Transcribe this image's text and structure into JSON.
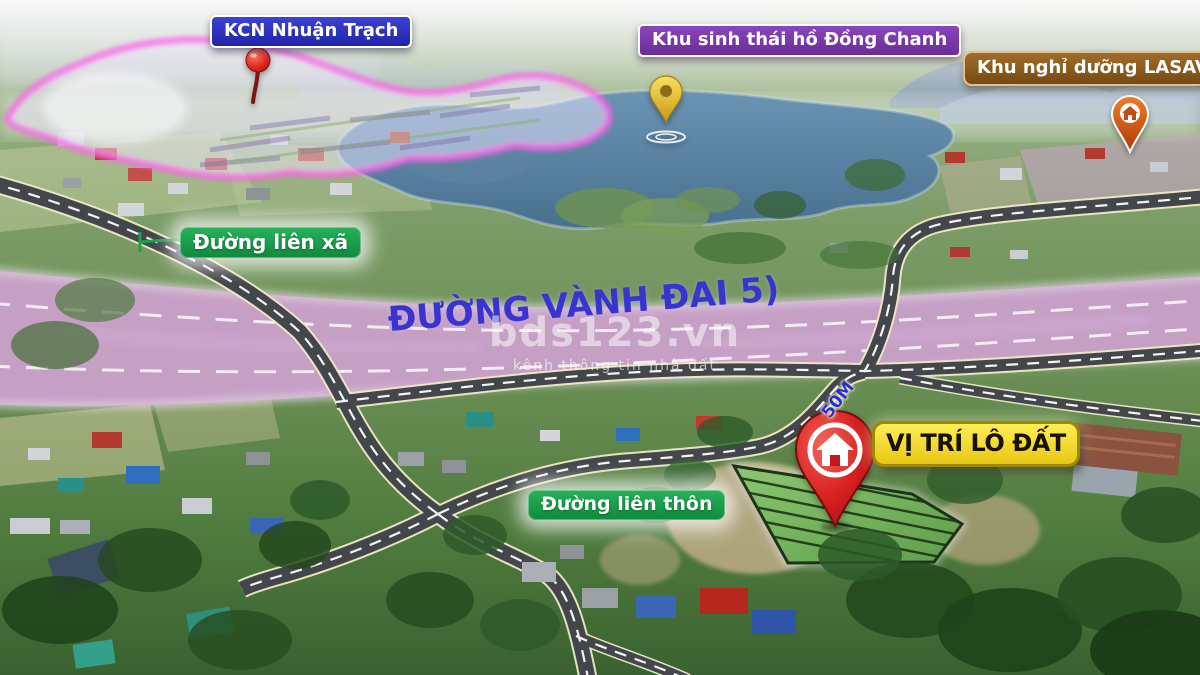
{
  "scene": {
    "type": "aerial-real-estate-location-map",
    "colors": {
      "industrial_sign_bg": "#2b32c8",
      "eco_sign_bg": "#7b3bad",
      "resort_sign_bg": "#8f5e1e",
      "road_sign_bg": "#159a4a",
      "location_sign_bg": "#f6e63c",
      "ring_road_text": "#3934cf",
      "corridor_fill": "#c79fc7",
      "plot_fill": "#7dbb67",
      "pin_red": "#d6201f",
      "pin_gold": "#e9c63c",
      "pin_orange": "#d95c18"
    }
  },
  "pois": {
    "industrial_zone": {
      "label": "KCN Nhuận Trạch",
      "pin": "red-circle-pin"
    },
    "eco_lake": {
      "label": "Khu sinh thái hồ Đồng Chanh",
      "pin": "gold-teardrop-pin"
    },
    "resort": {
      "label": "Khu nghỉ dưỡng LASAVER",
      "pin": "orange-house-pin"
    }
  },
  "roads": {
    "commune_road": {
      "label": "Đường liên xã"
    },
    "village_road": {
      "label": "Đường liên thôn"
    },
    "ring_road_5": {
      "label": "ĐƯỜNG VÀNH ĐAI 5)"
    },
    "frontage_width": {
      "label": "50M"
    }
  },
  "property": {
    "location_label": "VỊ TRÍ LÔ ĐẤT",
    "pin": "red-house-pin"
  },
  "watermark": {
    "brand": "bds123.vn",
    "tagline": "kênh thông tin nhà đất"
  }
}
